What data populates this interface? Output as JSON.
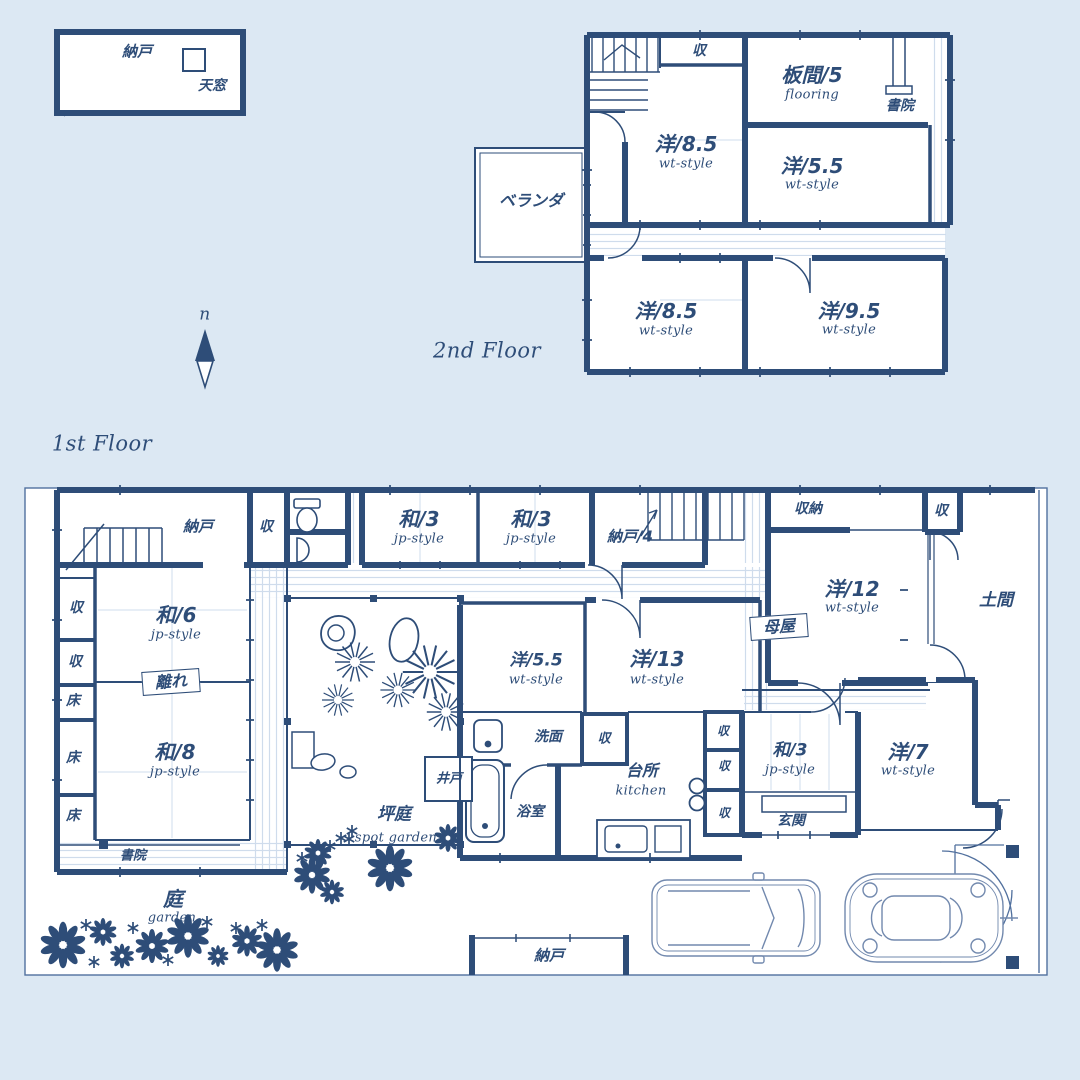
{
  "colors": {
    "background": "#dce8f3",
    "ink": "#2e4d78",
    "boundary": "#51709e",
    "car_line": "#7289ae"
  },
  "legend": {
    "storage": "納戸",
    "skylight": "天窓"
  },
  "compass": {
    "north": "n"
  },
  "floor2": {
    "title": "2nd Floor",
    "closet_top": "収",
    "itama": {
      "main": "板間/5",
      "sub": "flooring"
    },
    "shoin": "書院",
    "room_85a": {
      "main": "洋/8.5",
      "sub": "wt-style"
    },
    "room_55": {
      "main": "洋/5.5",
      "sub": "wt-style"
    },
    "veranda": "ベランダ",
    "room_85b": {
      "main": "洋/8.5",
      "sub": "wt-style"
    },
    "room_95": {
      "main": "洋/9.5",
      "sub": "wt-style"
    }
  },
  "floor1": {
    "title": "1st Floor",
    "nando_tl": "納戸",
    "closet_1": "収",
    "wa3_a": {
      "main": "和/3",
      "sub": "jp-style"
    },
    "wa3_b": {
      "main": "和/3",
      "sub": "jp-style"
    },
    "nando4": "納戸/4",
    "shuno": "収納",
    "closet_2": "収",
    "yo12": {
      "main": "洋/12",
      "sub": "wt-style"
    },
    "doma": "土間",
    "omoya": "母屋",
    "wa6": {
      "main": "和/6",
      "sub": "jp-style"
    },
    "hanare": "離れ",
    "closet_3": "収",
    "closet_4": "収",
    "toko_1": "床",
    "toko_2": "床",
    "toko_3": "床",
    "wa8": {
      "main": "和/8",
      "sub": "jp-style"
    },
    "shoin_1f": "書院",
    "tsuboniwa": {
      "main": "坪庭",
      "sub": "spot garden"
    },
    "ido": "井戸",
    "yo55": {
      "main": "洋/5.5",
      "sub": "wt-style"
    },
    "yo13": {
      "main": "洋/13",
      "sub": "wt-style"
    },
    "senmen": "洗面",
    "closet_5": "収",
    "yokushitsu": "浴室",
    "daidokoro": {
      "main": "台所",
      "sub": "kitchen"
    },
    "closet_6": "収",
    "closet_7": "収",
    "closet_8": "収",
    "wa3_c": {
      "main": "和/3",
      "sub": "jp-style"
    },
    "genkan": "玄関",
    "yo7": {
      "main": "洋/7",
      "sub": "wt-style"
    },
    "niwa": {
      "main": "庭",
      "sub": "garden"
    },
    "nando_bottom": "納戸"
  }
}
